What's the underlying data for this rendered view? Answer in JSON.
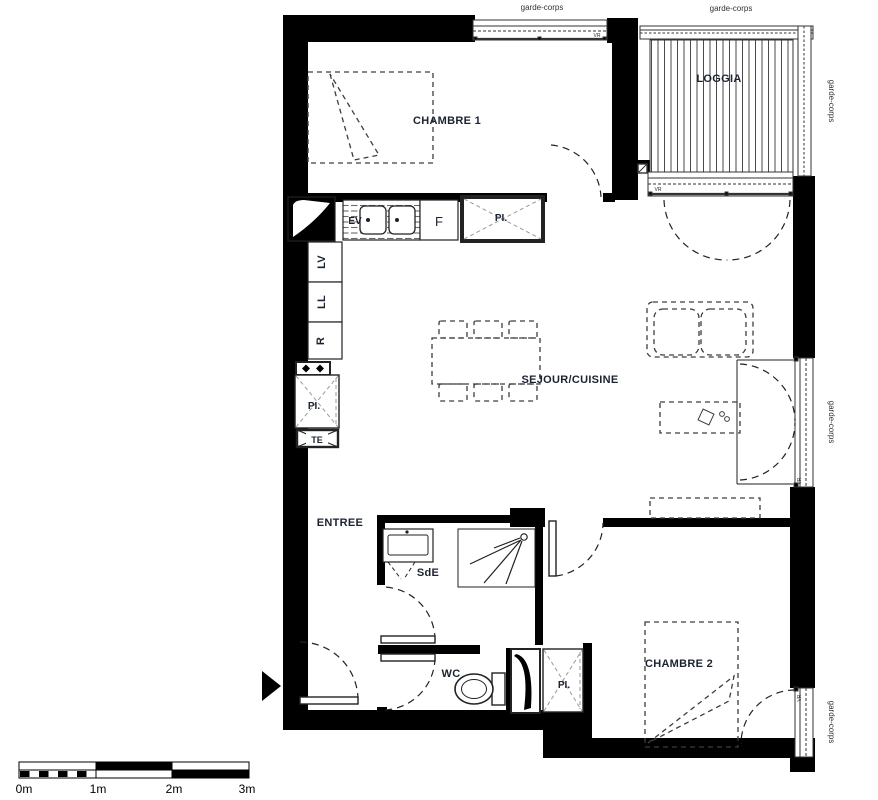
{
  "plan": {
    "rooms": {
      "chambre1": "CHAMBRE 1",
      "loggia": "LOGGIA",
      "sejour": "SEJOUR/CUISINE",
      "entree": "ENTREE",
      "sde": "SdE",
      "wc": "WC",
      "chambre2": "CHAMBRE 2"
    },
    "appliances": {
      "ev": "EV",
      "f": "F",
      "lv": "LV",
      "ll": "LL",
      "r": "R",
      "te": "TE"
    },
    "closets": {
      "kitchen": "PI.",
      "hall": "PI.",
      "wc": "PI."
    },
    "railings": {
      "top_left": "garde-corps",
      "top_right": "garde-corps",
      "right_upper": "garde-corps",
      "right_middle": "garde-corps",
      "right_lower": "garde-corps"
    },
    "windows": {
      "vr1": "VR",
      "vr2": "VR",
      "vr3": "VR",
      "vr4": "VR"
    },
    "scale_bar": {
      "labels": [
        "0m",
        "1m",
        "2m",
        "3m"
      ]
    },
    "colors": {
      "wall": "#000000",
      "bg": "#ffffff",
      "furniture": "#3d3d3d",
      "text": "#1b2330",
      "cross": "#9a9a9a"
    }
  }
}
